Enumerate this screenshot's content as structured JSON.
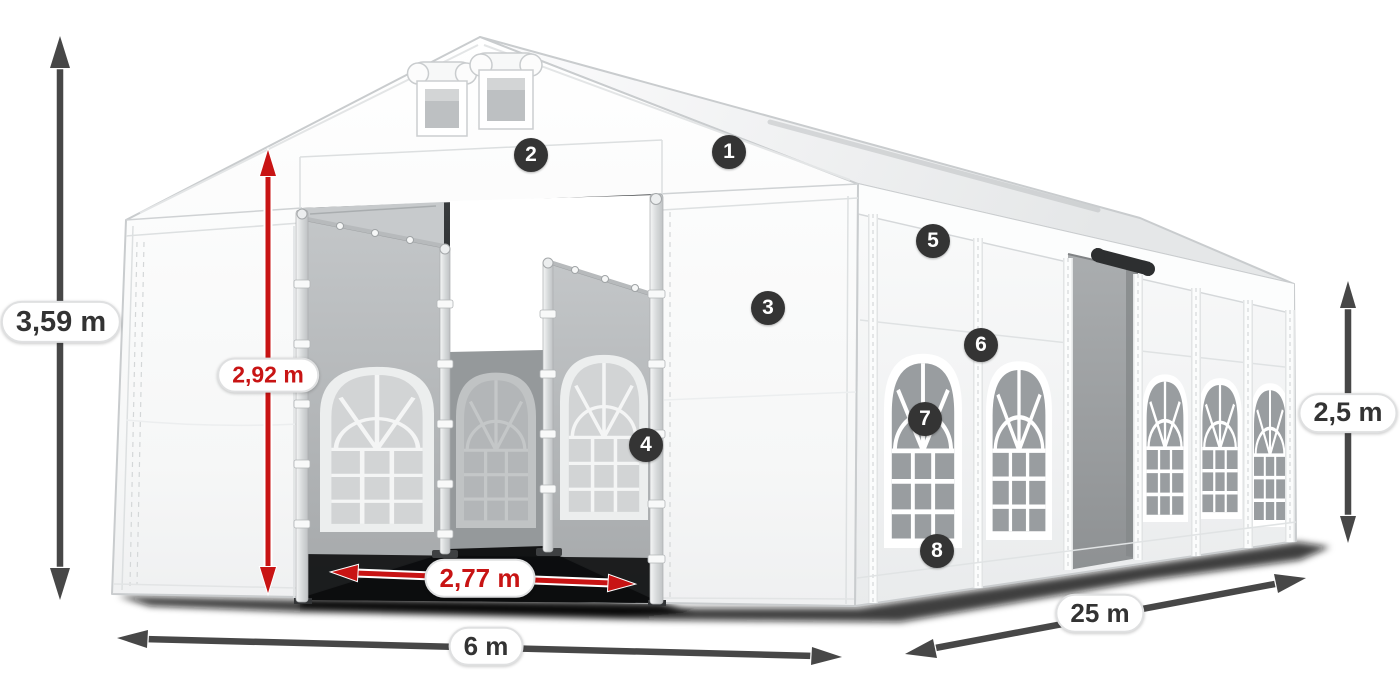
{
  "colors": {
    "dimension_red": "#c81414",
    "dimension_gray": "#474747",
    "label_text": "#333333",
    "badge_bg": "#343434",
    "badge_text": "#ffffff"
  },
  "diagram": {
    "type": "product_dimension_diagram",
    "dimensions": {
      "total_height": {
        "label": "3,59 m",
        "color": "gray",
        "orientation": "vertical"
      },
      "entrance_height": {
        "label": "2,92 m",
        "color": "red",
        "orientation": "vertical"
      },
      "entrance_width": {
        "label": "2,77 m",
        "color": "red",
        "orientation": "horizontal"
      },
      "front_width": {
        "label": "6 m",
        "color": "gray",
        "orientation": "horizontal"
      },
      "side_length": {
        "label": "25 m",
        "color": "gray",
        "orientation": "diagonal"
      },
      "side_height": {
        "label": "2,5 m",
        "color": "gray",
        "orientation": "vertical"
      }
    },
    "callouts": [
      {
        "number": "1"
      },
      {
        "number": "2"
      },
      {
        "number": "3"
      },
      {
        "number": "4"
      },
      {
        "number": "5"
      },
      {
        "number": "6"
      },
      {
        "number": "7"
      },
      {
        "number": "8"
      }
    ]
  }
}
